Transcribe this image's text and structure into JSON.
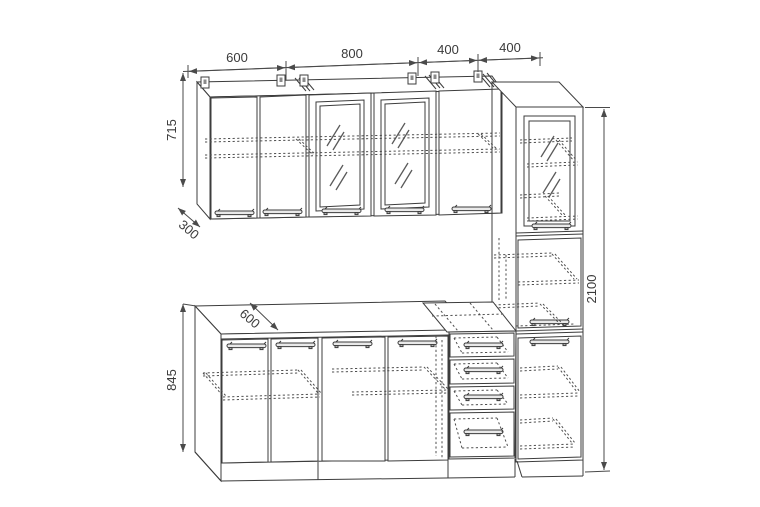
{
  "drawing": {
    "type": "kitchen-cabinet-set-technical-drawing",
    "dim": {
      "wall_widths": [
        "600",
        "800",
        "400",
        "400"
      ],
      "wall_cabinet_height": "715",
      "wall_cabinet_depth": "300",
      "base_cabinet_height": "845",
      "total_height": "2100",
      "base_counter_depth": "600"
    }
  }
}
